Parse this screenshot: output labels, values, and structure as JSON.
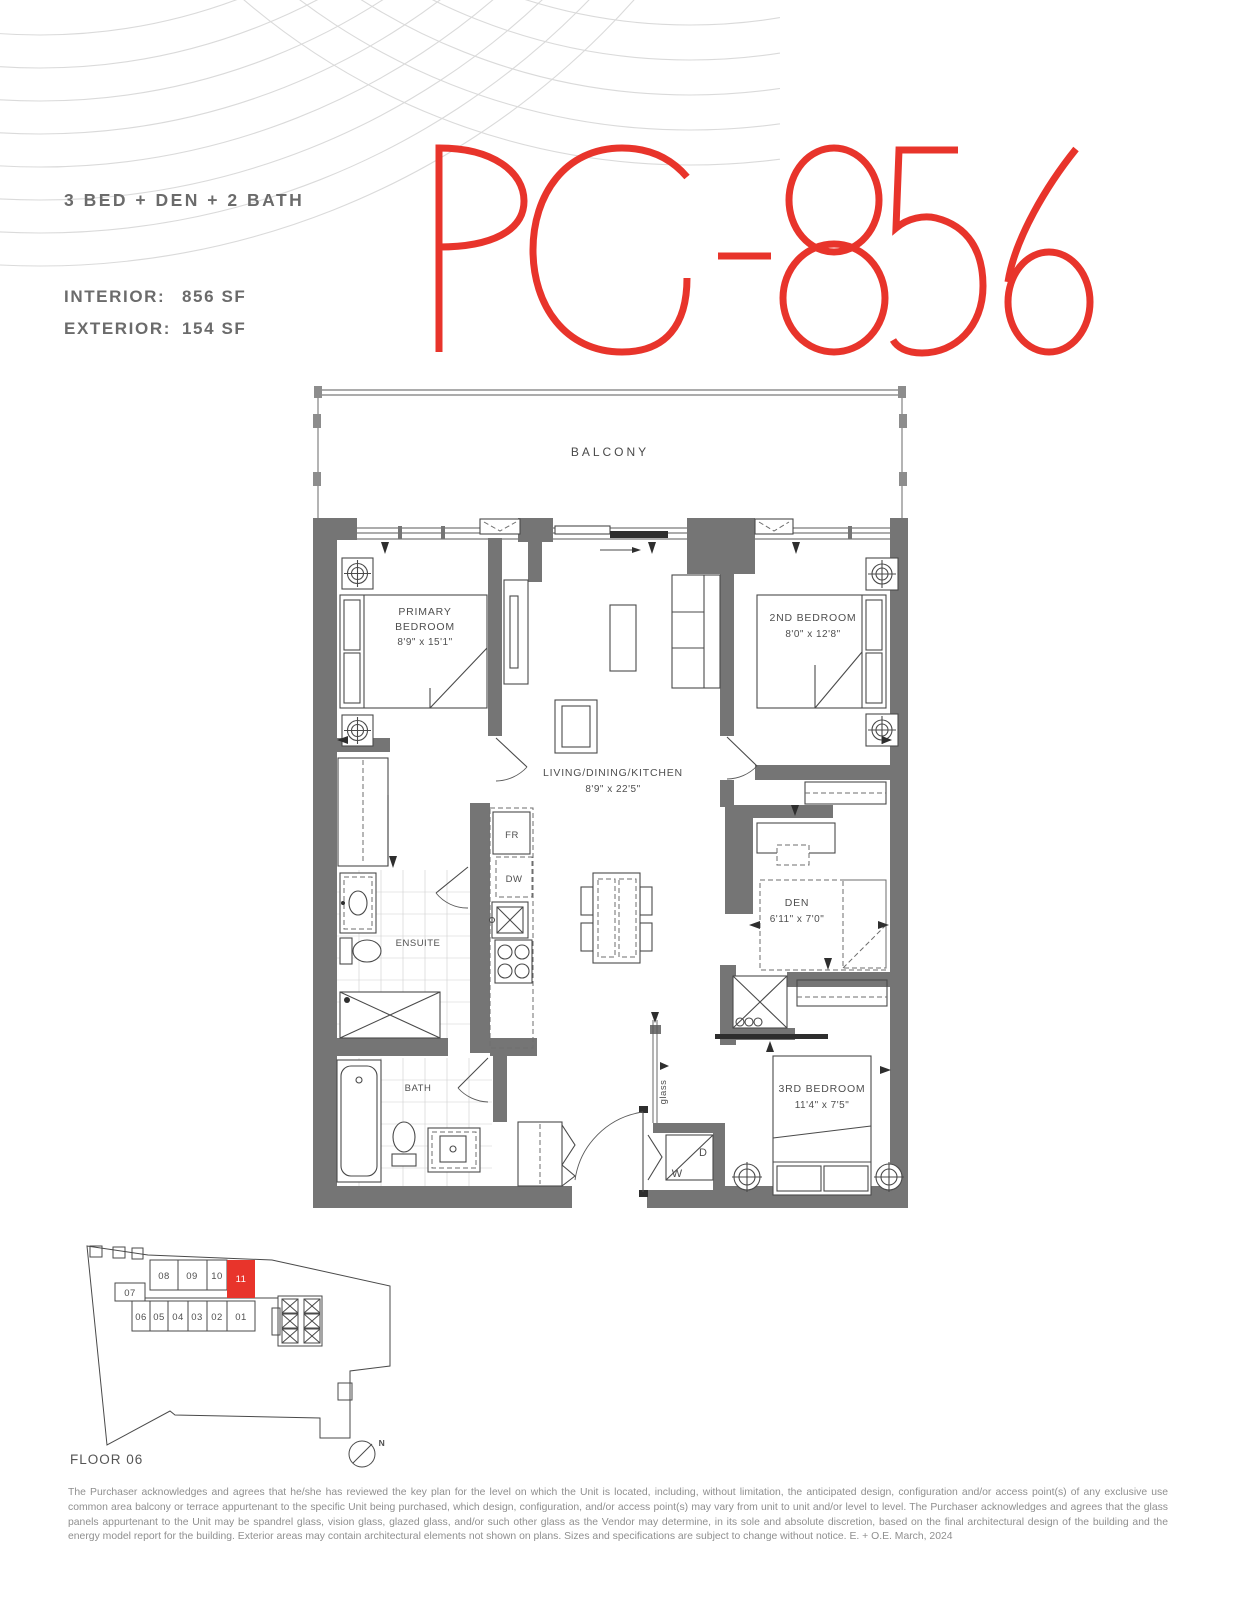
{
  "header": {
    "unit_type": "3 BED + DEN + 2 BATH",
    "interior_label": "INTERIOR:",
    "interior_value": "856 SF",
    "exterior_label": "EXTERIOR:",
    "exterior_value": "154 SF",
    "plan_code": "PG-856"
  },
  "colors": {
    "accent": "#e8342b",
    "wall": "#757575"
  },
  "floor_plan": {
    "balcony": "BALCONY",
    "primary_bedroom": {
      "line1": "PRIMARY",
      "line2": "BEDROOM",
      "dims": "8'9\" x 15'1\""
    },
    "second_bedroom": {
      "name": "2ND BEDROOM",
      "dims": "8'0\" x 12'8\""
    },
    "living": {
      "name": "LIVING/DINING/KITCHEN",
      "dims": "8'9\" x 22'5\""
    },
    "ensuite": "ENSUITE",
    "den": {
      "name": "DEN",
      "dims": "6'11\" x 7'0\""
    },
    "bath": "BATH",
    "third_bedroom": {
      "name": "3RD BEDROOM",
      "dims": "11'4\" x 7'5\""
    },
    "fridge": "FR",
    "dishwasher": "DW",
    "washer": "W",
    "dryer": "D",
    "glass": "glass"
  },
  "key_plan": {
    "floor_label": "FLOOR 06",
    "units": [
      "08",
      "09",
      "10",
      "11",
      "07",
      "06",
      "05",
      "04",
      "03",
      "02",
      "01"
    ],
    "highlighted_unit": "11",
    "north": "N"
  },
  "disclaimer": "The Purchaser acknowledges and agrees that he/she has reviewed the key plan for the level on which the Unit is located, including, without limitation, the anticipated design, configuration and/or access point(s) of any exclusive use common area balcony or terrace appurtenant to the specific Unit being purchased, which design, configuration, and/or access point(s) may vary from unit to unit and/or level to level. The Purchaser acknowledges and agrees that the glass panels appurtenant to the Unit may be spandrel glass, vision glass, glazed glass, and/or such other glass as the Vendor may determine, in its sole and absolute discretion, based on the final architectural design of the building and the energy model report for the building. Exterior areas may contain architectural elements not shown on plans. Sizes and specifications are subject to change without notice. E. + O.E. March, 2024"
}
